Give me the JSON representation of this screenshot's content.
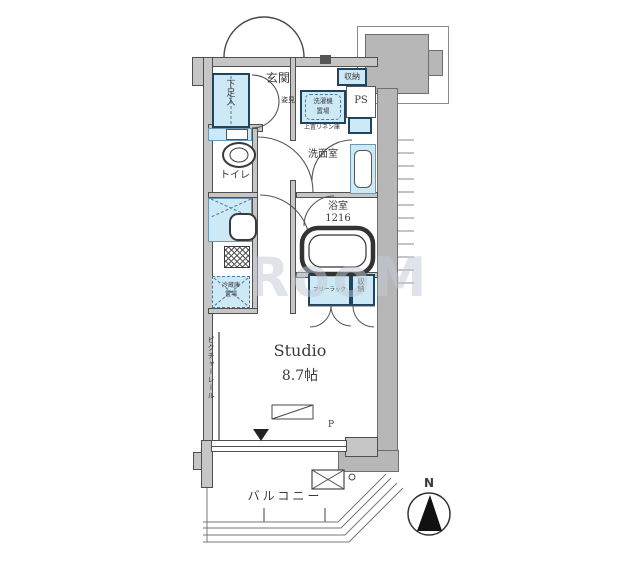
{
  "plan": {
    "labels": {
      "genkan": "玄関",
      "mirror": "姿見",
      "shoe_cabinet": "下足入",
      "storage_top": "収納",
      "ps": "PS",
      "washer_line1": "洗濯機",
      "washer_line2": "置場",
      "linen": "上置リネン庫",
      "washroom": "洗面室",
      "bathroom": "浴室",
      "bathroom_size": "1216",
      "toilet": "トイレ",
      "fridge_line1": "冷蔵庫",
      "fridge_line2": "置場",
      "free_rack": "フリーラック",
      "storage_closet": "収納",
      "room_name": "Studio",
      "room_size": "8.7帖",
      "picture_rail": "ピクチャーレール",
      "balcony": "バルコニー",
      "p_mark": "P",
      "compass_n": "N"
    },
    "watermark": "RooM"
  },
  "colors": {
    "fixture_blue": "#cde9f6",
    "fixture_border_dark": "#1f4460",
    "wall_gray": "#c6c6c6",
    "block_gray": "#b7b7b7",
    "line": "#4a4a4a",
    "watermark": "#c3cbd6"
  }
}
